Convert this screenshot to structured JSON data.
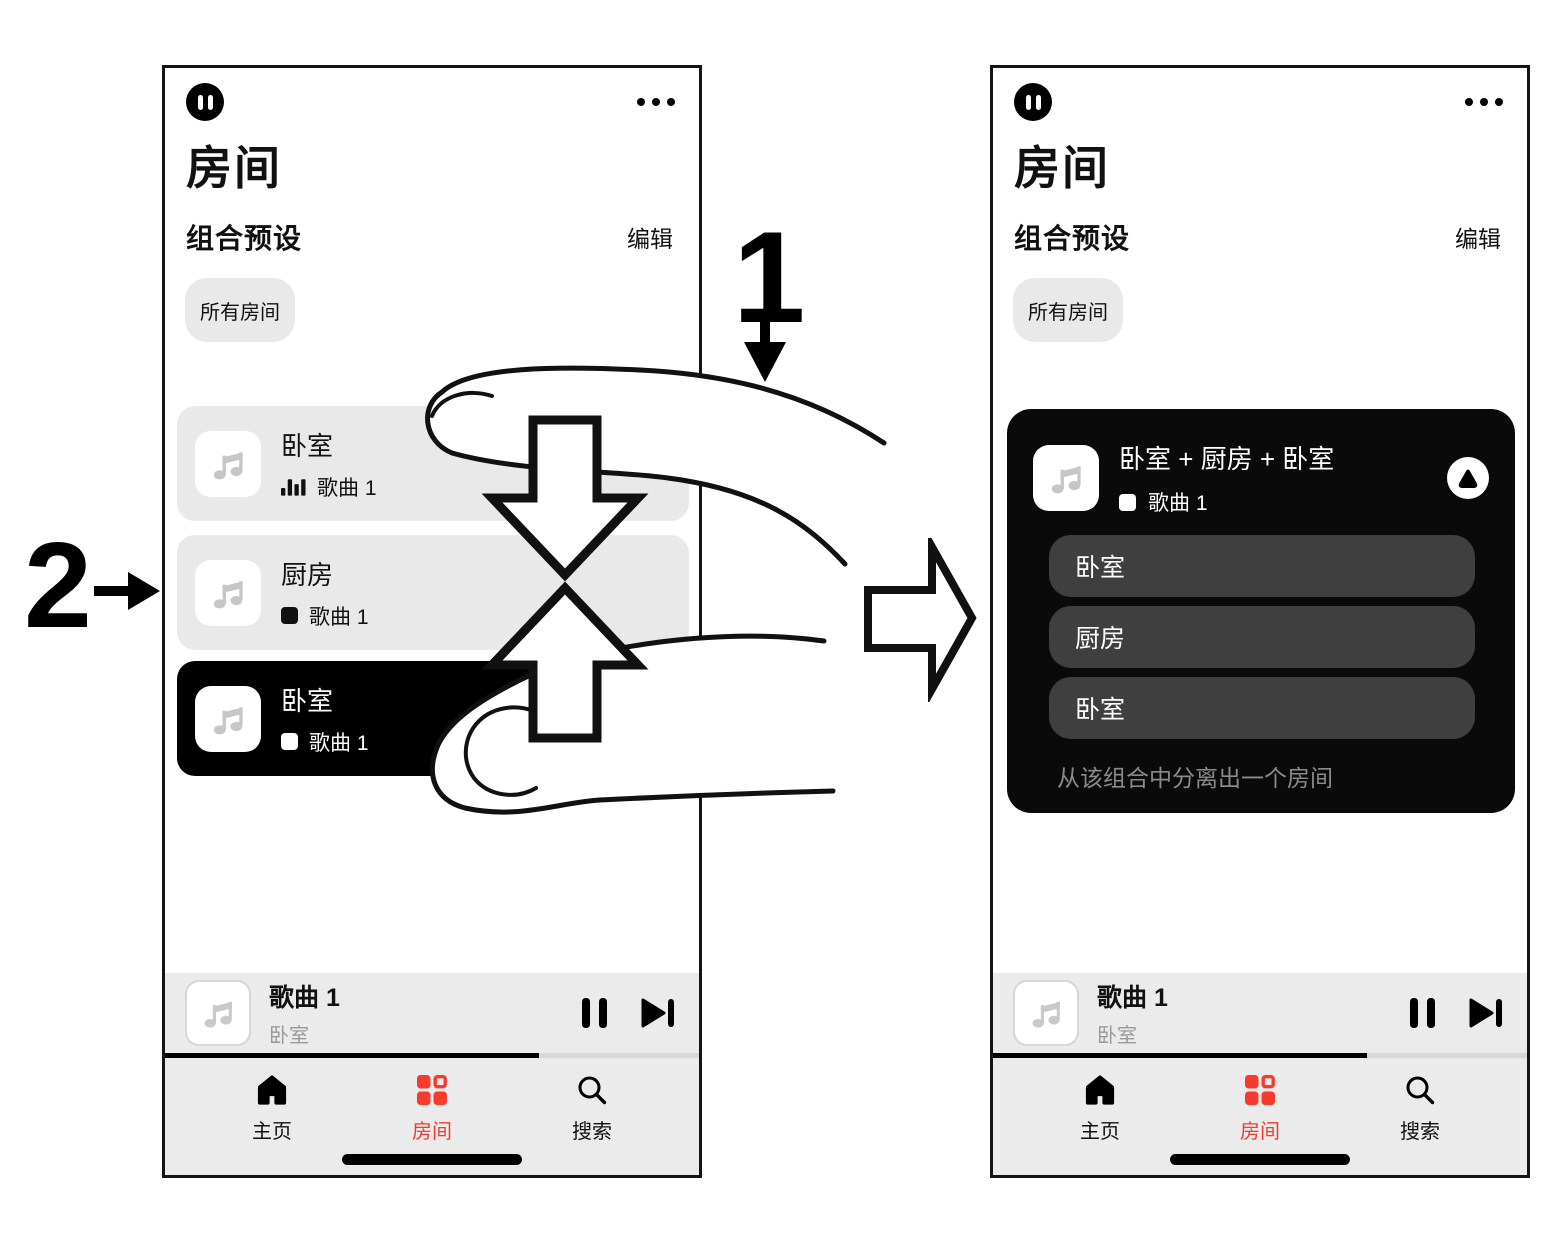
{
  "annotations": {
    "step1_label": "1",
    "step2_label": "2"
  },
  "shared": {
    "screen_title": "房间",
    "section_title": "组合预设",
    "edit_button": "编辑",
    "all_rooms_chip": "所有房间",
    "player": {
      "track": "歌曲 1",
      "room": "卧室"
    },
    "tabs": [
      {
        "label": "主页",
        "active": false
      },
      {
        "label": "房间",
        "active": true
      },
      {
        "label": "搜索",
        "active": false
      }
    ],
    "progress_percent": 70
  },
  "left_screen": {
    "rooms": [
      {
        "name": "卧室",
        "track": "歌曲 1",
        "status": "playing"
      },
      {
        "name": "厨房",
        "track": "歌曲 1",
        "status": "stopped"
      },
      {
        "name": "卧室",
        "track": "歌曲 1",
        "status": "stopped",
        "selected": true
      }
    ]
  },
  "right_screen": {
    "group": {
      "title": "卧室 + 厨房 + 卧室",
      "track": "歌曲 1",
      "rooms": [
        "卧室",
        "厨房",
        "卧室"
      ],
      "hint": "从该组合中分离出一个房间"
    }
  },
  "colors": {
    "accent_red": "#f43b2e",
    "card_gray": "#e9e9e9",
    "bar_gray": "#ebebeb",
    "pill_dark": "#3f3f3f"
  }
}
